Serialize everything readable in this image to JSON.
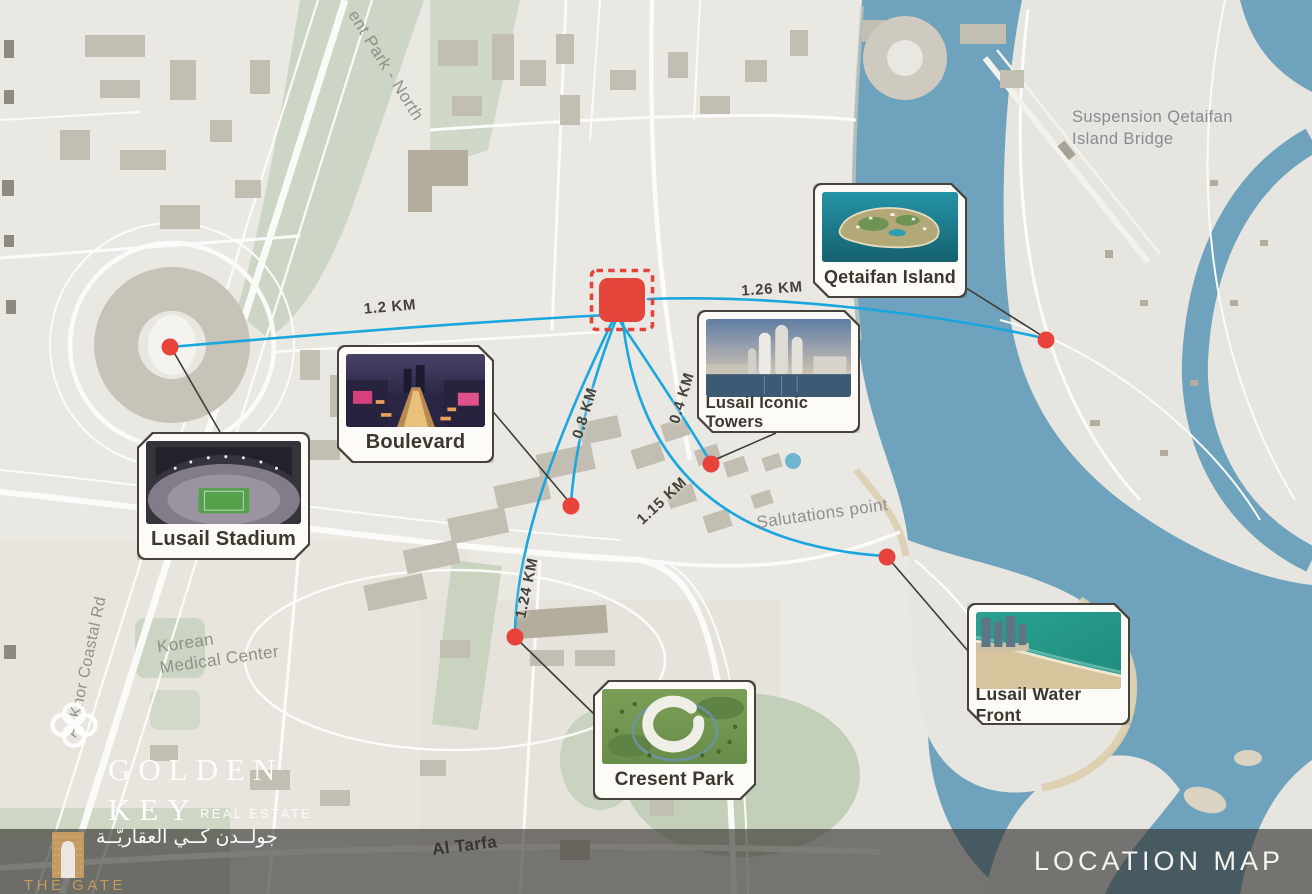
{
  "header": {
    "location_map_label": "LOCATION MAP"
  },
  "brand": {
    "golden": "GOLDEN",
    "key": "KEY",
    "real_estate": "REAL ESTATE",
    "arabic_name": "جولــدن كــي العقاريّــة",
    "the_gate": "THE GATE"
  },
  "locations": [
    {
      "id": "lusail-stadium",
      "name": "Lusail Stadium",
      "distance": "1.2 KM"
    },
    {
      "id": "boulevard",
      "name": "Boulevard",
      "distance": "0.8 KM"
    },
    {
      "id": "cresent-park",
      "name": "Cresent Park",
      "distance": "1.24 KM"
    },
    {
      "id": "lusail-iconic-towers",
      "name": "Lusail Iconic Towers",
      "distance": "0.4 KM"
    },
    {
      "id": "lusail-water-front",
      "name": "Lusail Water Front",
      "distance": "1.15 KM"
    },
    {
      "id": "qetaifan-island",
      "name": "Qetaifan Island",
      "distance": "1.26 KM"
    }
  ],
  "map_labels": {
    "park_north": "ent Park - North",
    "bridge_line1": "Suspension Qetaifan",
    "bridge_line2": "Island Bridge",
    "salutations_point": "Salutations point",
    "korean_line1": "Korean",
    "korean_line2": "Medical Center",
    "coastal_road": "Al Khor Coastal Rd",
    "al_tarfa": "Al Tarfa"
  },
  "colors": {
    "marker_red": "#e5443b",
    "route_blue": "#1aa7e0",
    "water_blue": "#6fa3bd",
    "brand_gold": "#c49a60"
  }
}
